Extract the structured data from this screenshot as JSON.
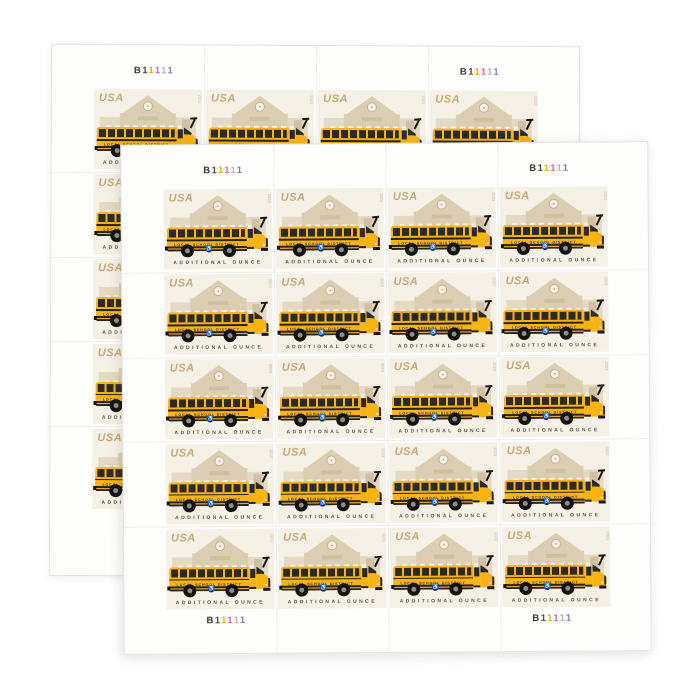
{
  "window": {
    "background": "#ffffff"
  },
  "sheet": {
    "grid": {
      "rows": 5,
      "cols": 4
    },
    "plate_number": {
      "value": "B11111",
      "glyphs": [
        {
          "char": "B",
          "color": "#3b3b3b"
        },
        {
          "char": "1",
          "color": "#4a4a4a"
        },
        {
          "char": "1",
          "color": "#d9b404"
        },
        {
          "char": "1",
          "color": "#cf6d9a"
        },
        {
          "char": "1",
          "color": "#bdb6a6"
        },
        {
          "char": "1",
          "color": "#7189b5"
        }
      ]
    },
    "stamp": {
      "country": "USA",
      "denomination_text": "ADDITIONAL OUNCE",
      "bus_side_text": "LOCAL SCHOOL DISTRICT",
      "year_mark": "2023",
      "icons": {
        "wheelchair": "♿"
      },
      "colors": {
        "stamp_background": "#f6f1e6",
        "schoolhouse_tan": "#dbceb3",
        "schoolhouse_light_tan": "#e4d9c3",
        "bus_yellow": "#f8b314",
        "bus_dark": "#27241e",
        "caption_gray": "#57534b",
        "usa_tan": "#c8a97a"
      }
    }
  }
}
